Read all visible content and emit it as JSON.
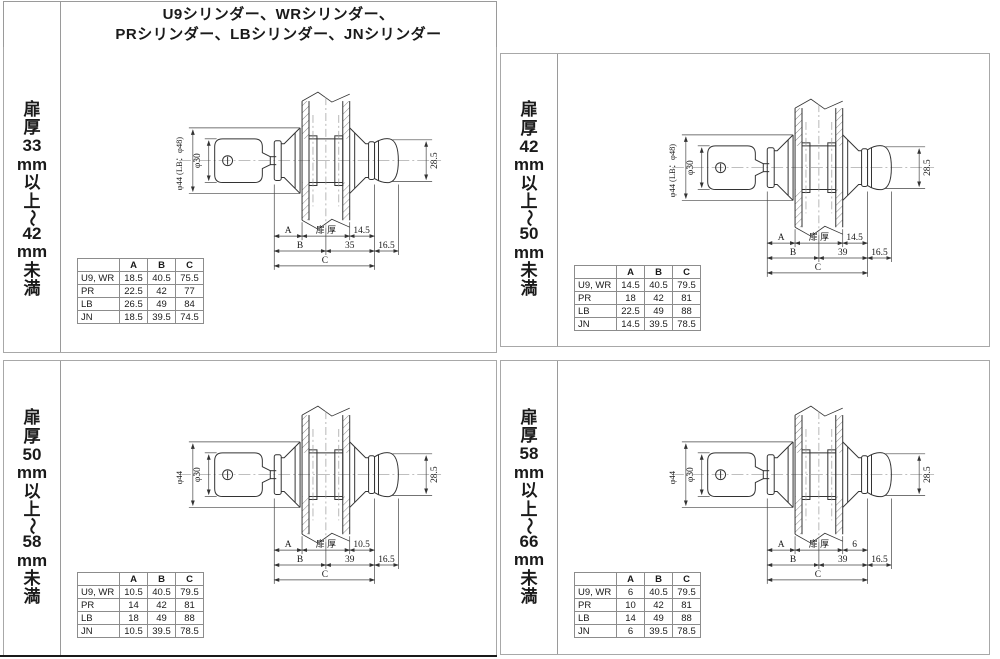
{
  "header": {
    "title_line1": "U9シリンダー、WRシリンダー、",
    "title_line2": "PRシリンダー、LBシリンダー、JNシリンダー"
  },
  "colors": {
    "drawing_line": "#333333",
    "grid_line": "#9a9a9a",
    "bottom_rule": "#1a1a1a"
  },
  "quadrants": [
    {
      "door_label": "扉厚33mm以上〜42mm未満",
      "drawing": {
        "outer_dia": "φ44 (LB：φ48)",
        "plug_dia": "φ30",
        "knob_height": "28.5",
        "dim_a_label": "A",
        "door_thickness_label": "扉 厚",
        "back_offset": "14.5",
        "dim_b_label": "B",
        "center_to_back": "35",
        "knob_depth": "16.5",
        "dim_c_label": "C"
      },
      "table": {
        "col_headers": [
          "A",
          "B",
          "C"
        ],
        "rows": [
          {
            "name": "U9, WR",
            "a": "18.5",
            "b": "40.5",
            "c": "75.5"
          },
          {
            "name": "PR",
            "a": "22.5",
            "b": "42",
            "c": "77"
          },
          {
            "name": "LB",
            "a": "26.5",
            "b": "49",
            "c": "84"
          },
          {
            "name": "JN",
            "a": "18.5",
            "b": "39.5",
            "c": "74.5"
          }
        ]
      }
    },
    {
      "door_label": "扉厚42mm以上〜50mm未満",
      "drawing": {
        "outer_dia": "φ44 (LB：φ48)",
        "plug_dia": "φ30",
        "knob_height": "28.5",
        "dim_a_label": "A",
        "door_thickness_label": "扉 厚",
        "back_offset": "14.5",
        "dim_b_label": "B",
        "center_to_back": "39",
        "knob_depth": "16.5",
        "dim_c_label": "C"
      },
      "table": {
        "col_headers": [
          "A",
          "B",
          "C"
        ],
        "rows": [
          {
            "name": "U9, WR",
            "a": "14.5",
            "b": "40.5",
            "c": "79.5"
          },
          {
            "name": "PR",
            "a": "18",
            "b": "42",
            "c": "81"
          },
          {
            "name": "LB",
            "a": "22.5",
            "b": "49",
            "c": "88"
          },
          {
            "name": "JN",
            "a": "14.5",
            "b": "39.5",
            "c": "78.5"
          }
        ]
      }
    },
    {
      "door_label": "扉厚50mm以上〜58mm未満",
      "drawing": {
        "outer_dia": "φ44",
        "plug_dia": "φ30",
        "knob_height": "28.5",
        "dim_a_label": "A",
        "door_thickness_label": "扉 厚",
        "back_offset": "10.5",
        "dim_b_label": "B",
        "center_to_back": "39",
        "knob_depth": "16.5",
        "dim_c_label": "C"
      },
      "table": {
        "col_headers": [
          "A",
          "B",
          "C"
        ],
        "rows": [
          {
            "name": "U9, WR",
            "a": "10.5",
            "b": "40.5",
            "c": "79.5"
          },
          {
            "name": "PR",
            "a": "14",
            "b": "42",
            "c": "81"
          },
          {
            "name": "LB",
            "a": "18",
            "b": "49",
            "c": "88"
          },
          {
            "name": "JN",
            "a": "10.5",
            "b": "39.5",
            "c": "78.5"
          }
        ]
      }
    },
    {
      "door_label": "扉厚58mm以上〜66mm未満",
      "drawing": {
        "outer_dia": "φ44",
        "plug_dia": "φ30",
        "knob_height": "28.5",
        "dim_a_label": "A",
        "door_thickness_label": "扉 厚",
        "back_offset": "6",
        "dim_b_label": "B",
        "center_to_back": "39",
        "knob_depth": "16.5",
        "dim_c_label": "C"
      },
      "table": {
        "col_headers": [
          "A",
          "B",
          "C"
        ],
        "rows": [
          {
            "name": "U9, WR",
            "a": "6",
            "b": "40.5",
            "c": "79.5"
          },
          {
            "name": "PR",
            "a": "10",
            "b": "42",
            "c": "81"
          },
          {
            "name": "LB",
            "a": "14",
            "b": "49",
            "c": "88"
          },
          {
            "name": "JN",
            "a": "6",
            "b": "39.5",
            "c": "78.5"
          }
        ]
      }
    }
  ]
}
